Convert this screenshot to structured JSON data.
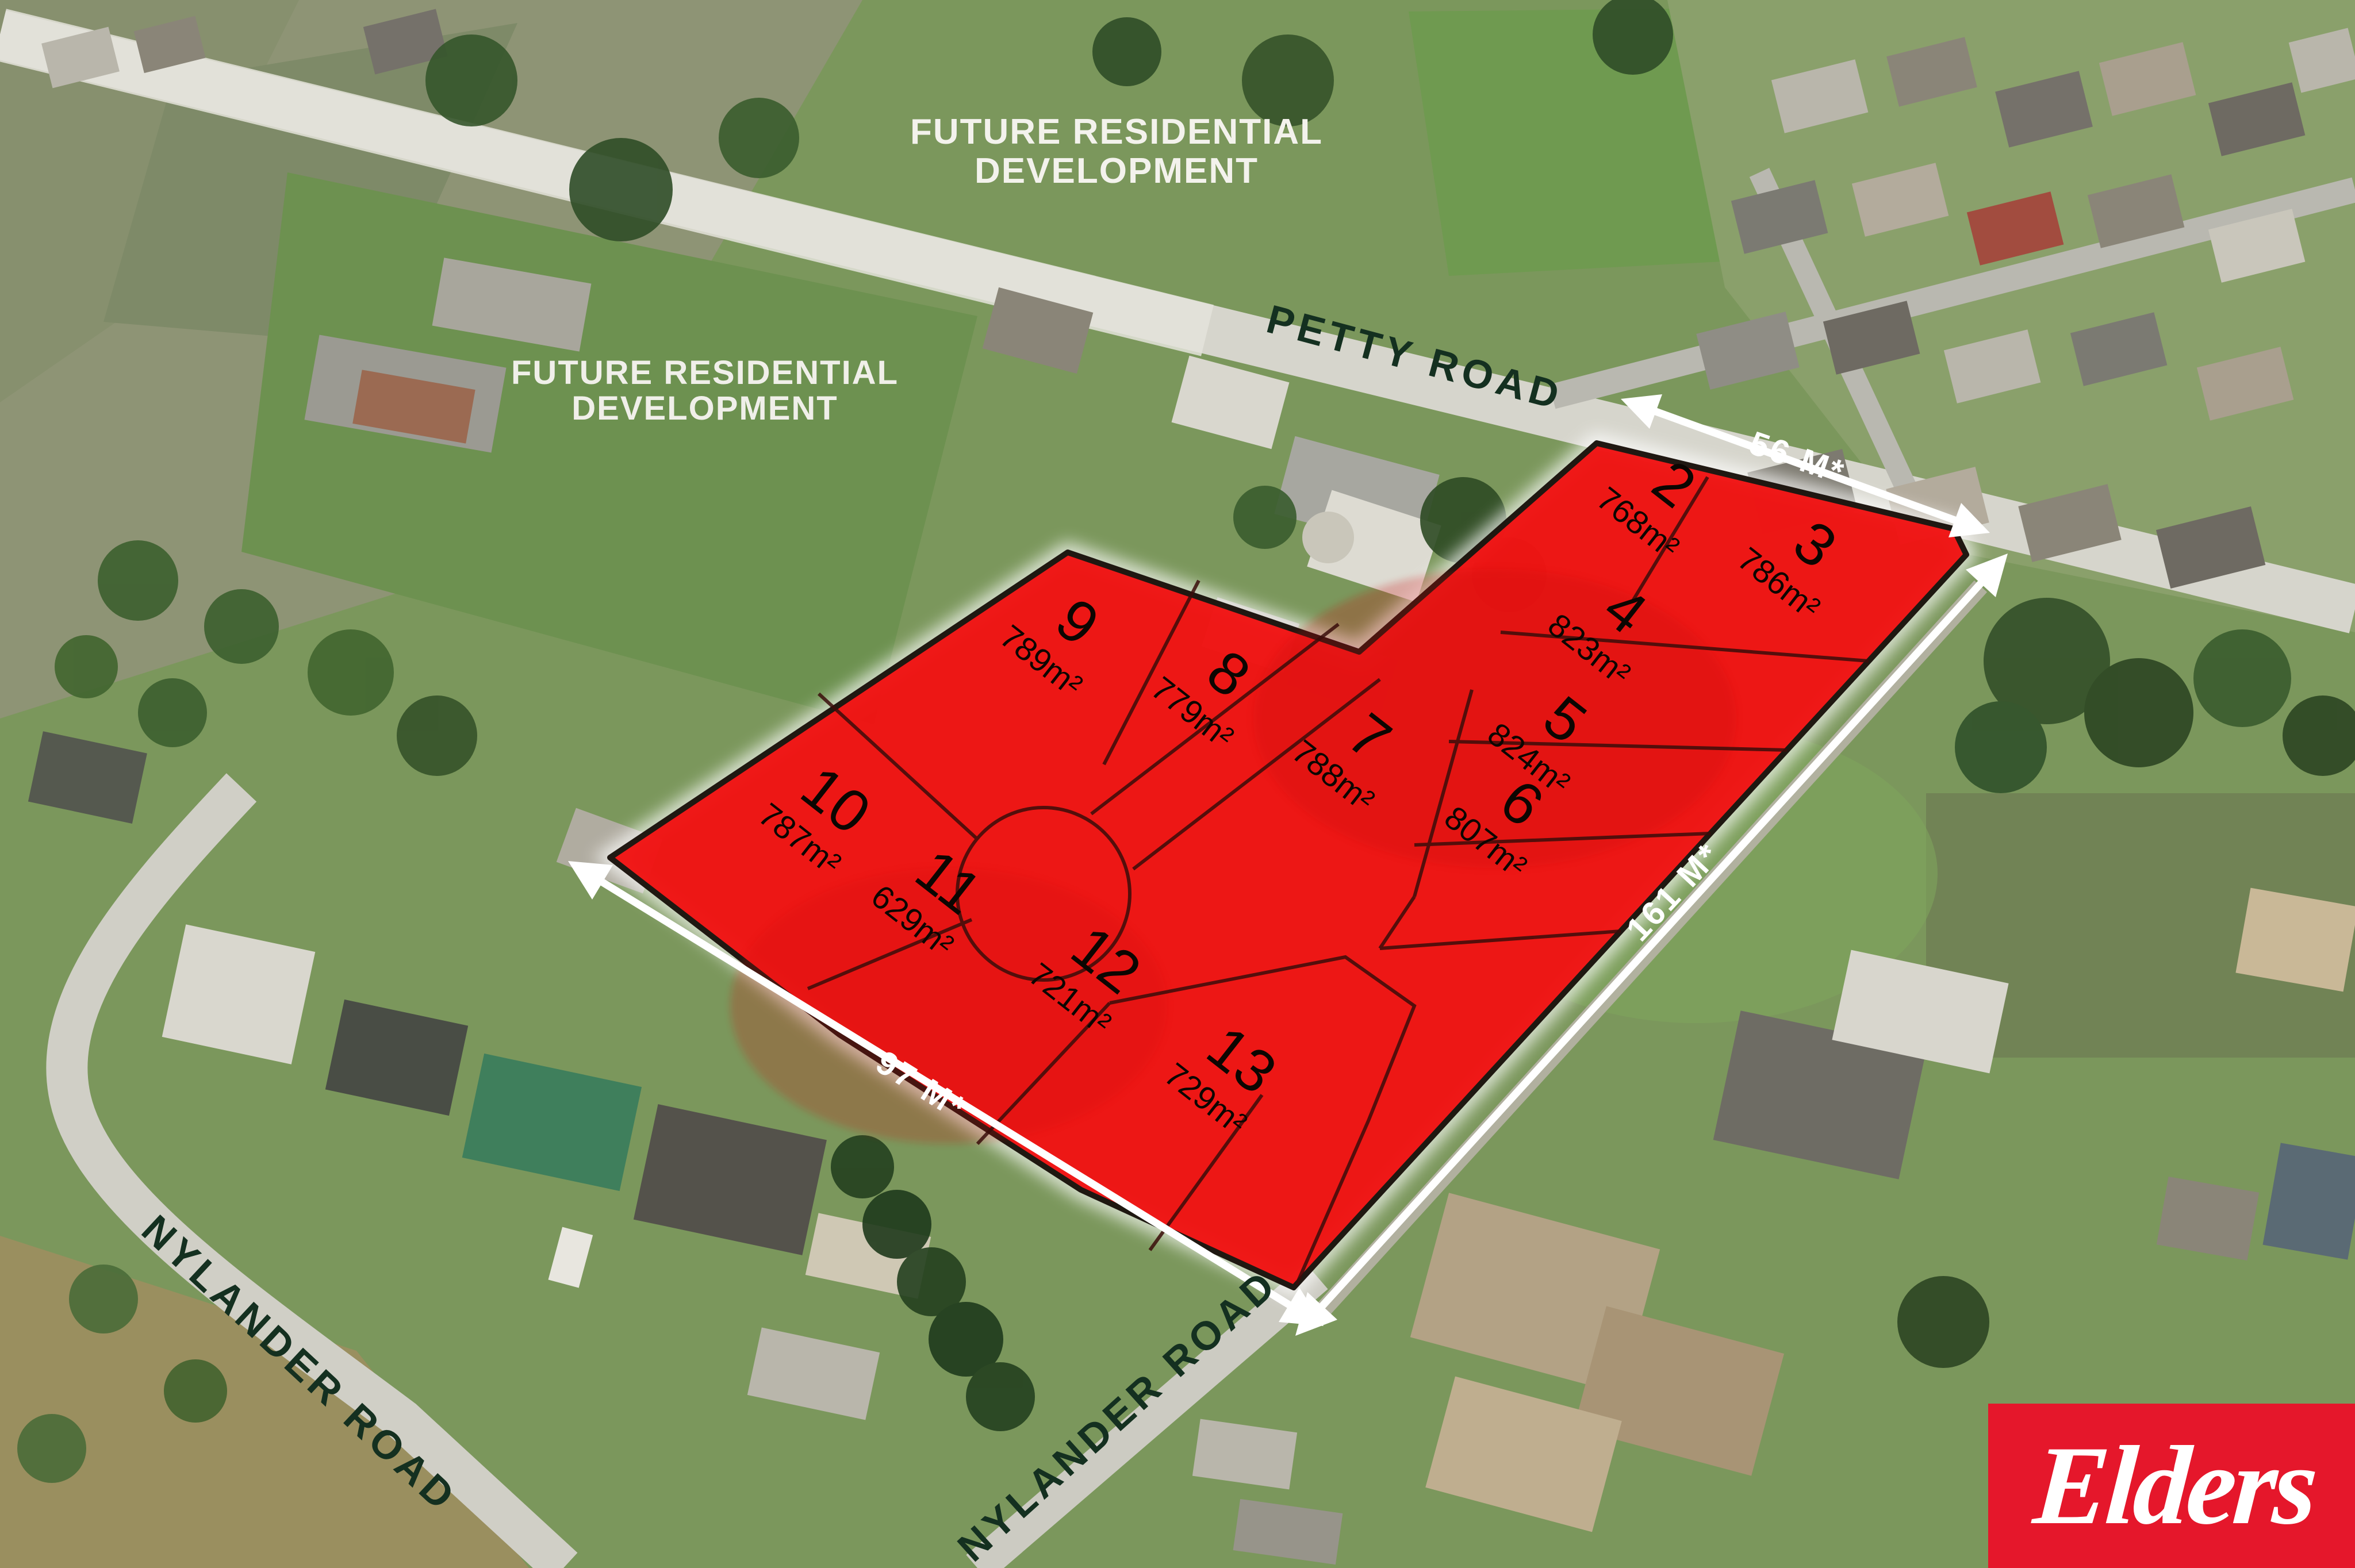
{
  "development": {
    "future_label_line1": "FUTURE RESIDENTIAL",
    "future_label_line2": "DEVELOPMENT"
  },
  "roads": {
    "petty": "PETTY ROAD",
    "nylander_left": "NYLANDER ROAD",
    "nylander_bottom": "NYLANDER ROAD"
  },
  "measurements": {
    "frontage_top": "56 M*",
    "side_right": "161 M*",
    "side_bottom": "97 M*"
  },
  "lots": [
    {
      "number": "2",
      "area": "768m²"
    },
    {
      "number": "3",
      "area": "786m²"
    },
    {
      "number": "4",
      "area": "823m²"
    },
    {
      "number": "5",
      "area": "824m²"
    },
    {
      "number": "6",
      "area": "807m²"
    },
    {
      "number": "7",
      "area": "788m²"
    },
    {
      "number": "8",
      "area": "779m²"
    },
    {
      "number": "9",
      "area": "789m²"
    },
    {
      "number": "10",
      "area": "787m²"
    },
    {
      "number": "11",
      "area": "629m²"
    },
    {
      "number": "12",
      "area": "721m²"
    },
    {
      "number": "13",
      "area": "729m²"
    }
  ],
  "branding": {
    "agency_name": "Elders"
  },
  "colors": {
    "overlay_red": "#f11313",
    "elders_red": "#e5172b",
    "road_label_green": "#143020",
    "arrow_white": "#ffffff"
  }
}
